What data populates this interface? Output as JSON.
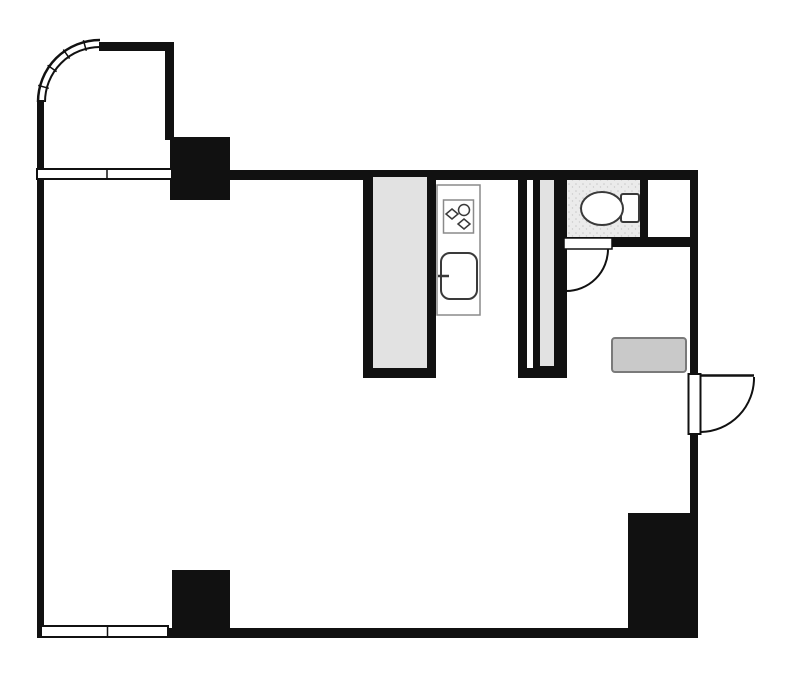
{
  "colors": {
    "wall": "#111111",
    "wall_fill": "#e2e2e2",
    "floor": "#ebebeb",
    "floor_dot": "#c9c9c9",
    "paper": "#ffffff",
    "counter_line": "#8a8a8a",
    "fixture_line": "#3a3a3a",
    "cabinet_fill": "#c9c9c9",
    "cabinet_border": "#7a7a7a"
  },
  "plan": {
    "kind": "apartment-floor-plan",
    "fixtures": [
      {
        "name": "curved-corner-window",
        "location": "top-left-balcony"
      },
      {
        "name": "sash-window",
        "location": "upper-left-wall"
      },
      {
        "name": "sash-window",
        "location": "bottom-left-wall"
      },
      {
        "name": "structural-pillar",
        "location": "top-left"
      },
      {
        "name": "structural-pillar",
        "location": "bottom-left"
      },
      {
        "name": "structural-pillar",
        "location": "bottom-right"
      },
      {
        "name": "partition-wall",
        "location": "kitchen-left"
      },
      {
        "name": "partition-wall",
        "location": "kitchen-right"
      },
      {
        "name": "kitchen-counter",
        "location": "kitchen"
      },
      {
        "name": "gas-stove",
        "location": "kitchen-counter"
      },
      {
        "name": "kitchen-sink",
        "location": "kitchen-counter"
      },
      {
        "name": "toilet",
        "location": "wc-room"
      },
      {
        "name": "swing-door",
        "location": "wc-room"
      },
      {
        "name": "entrance-swing-door",
        "location": "right-wall"
      },
      {
        "name": "shoe-cabinet",
        "location": "entrance-hall"
      }
    ]
  }
}
